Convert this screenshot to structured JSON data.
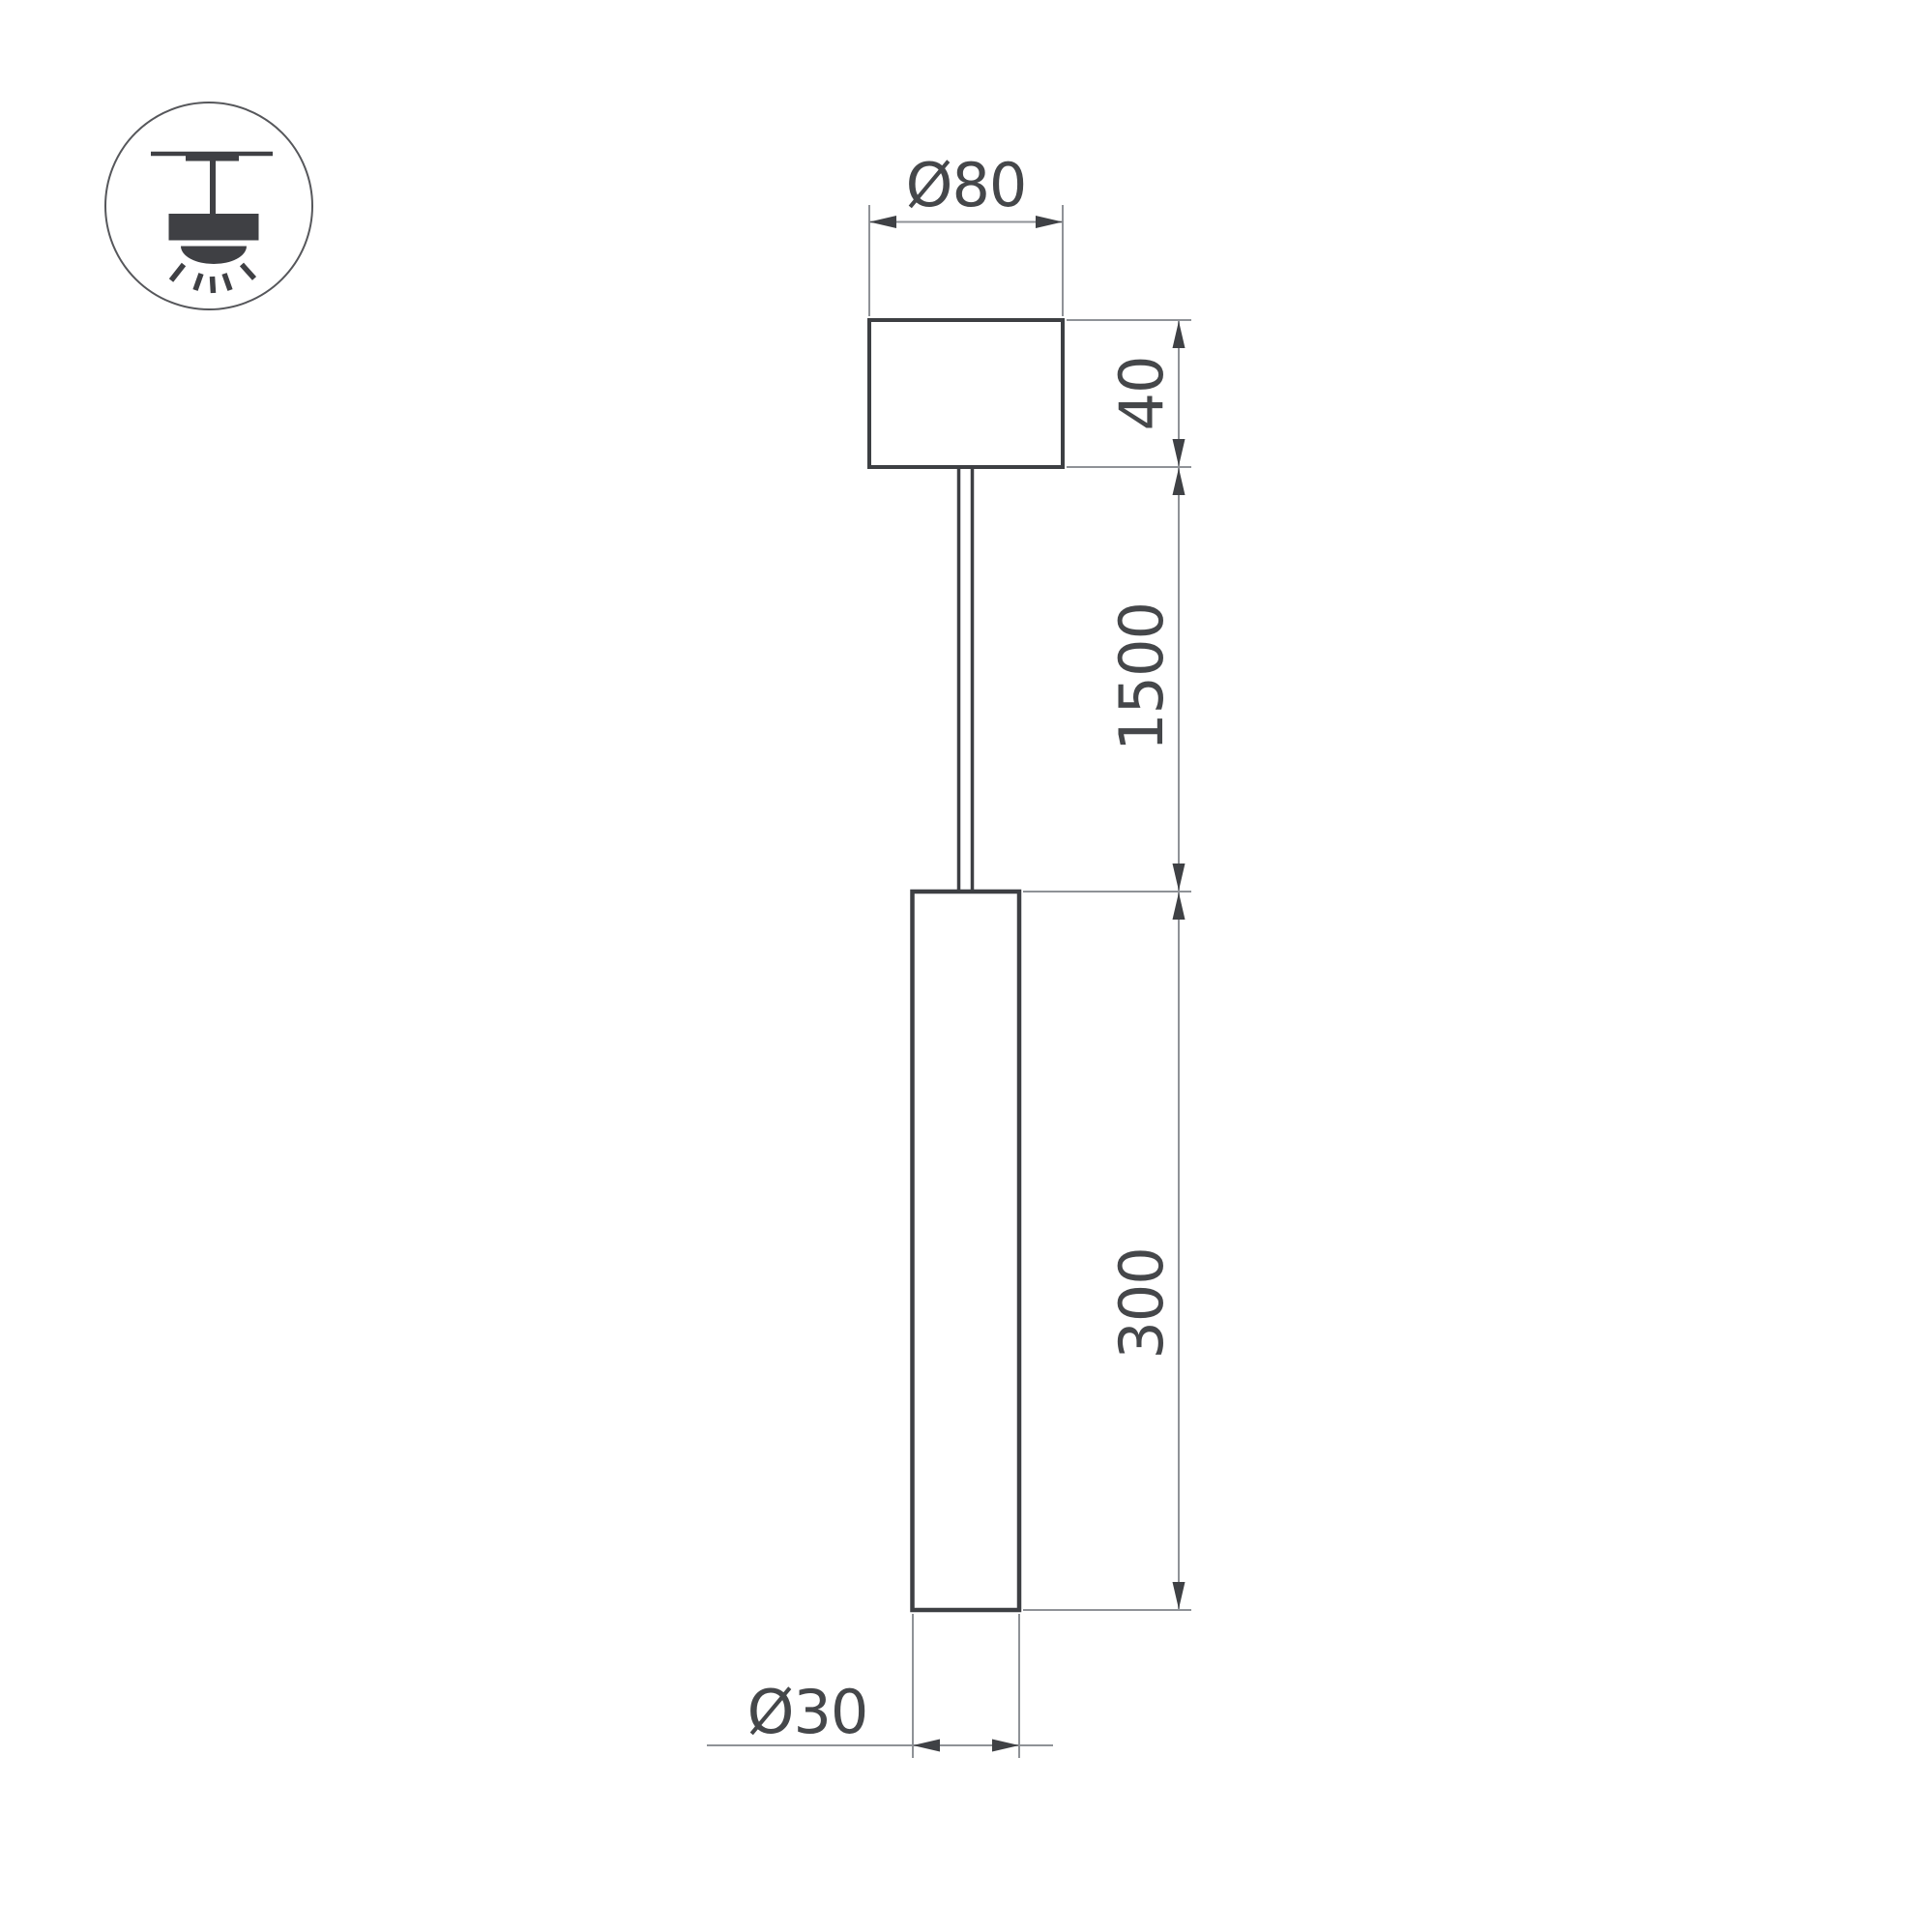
{
  "colors": {
    "background": "#ffffff",
    "outline": "#3d3f43",
    "dimension_line": "#8f9297",
    "arrow": "#3f4145",
    "text": "#45474a",
    "icon": "#3f4044"
  },
  "icon": {
    "name": "ceiling-pendant-mount-icon"
  },
  "labels": {
    "canopy_diameter": "Ø80",
    "canopy_height": "40",
    "suspension_length": "1500",
    "body_length": "300",
    "body_diameter": "Ø30"
  }
}
